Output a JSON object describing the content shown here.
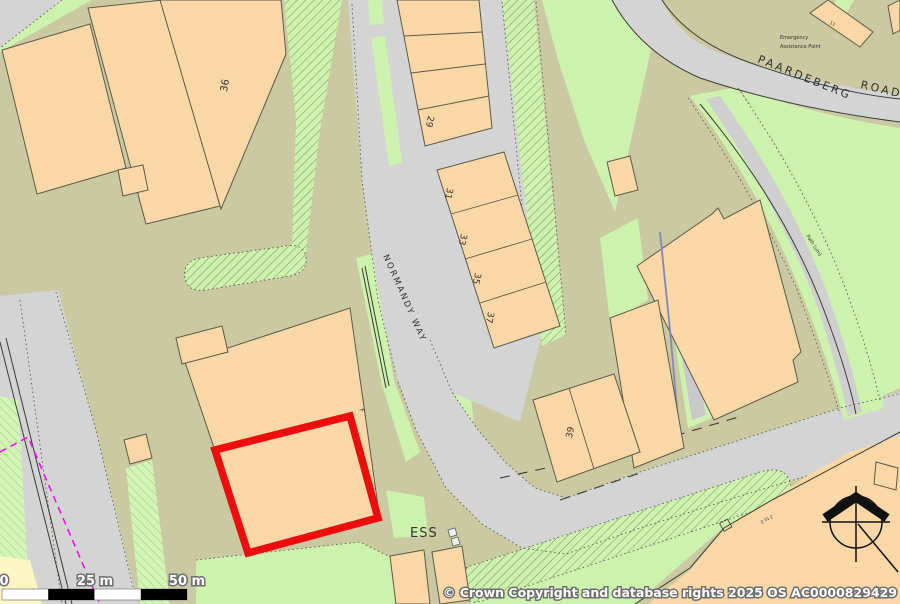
{
  "map": {
    "roads": {
      "normandy_way": "NORMANDY WAY",
      "paardeberg": "PAARDEBERG",
      "road_suffix": "ROAD"
    },
    "labels": {
      "ess": "ESS",
      "emergency_line1": "Emergency",
      "emergency_line2": "Assistance Point",
      "path": "Path (um)",
      "unit_range": "2 to 3",
      "floor_marker": "F"
    },
    "building_numbers": {
      "n36": "36",
      "n29": "29",
      "n31": "31",
      "n33": "33",
      "n35": "35",
      "n37": "37",
      "n39": "39",
      "n11": "11"
    },
    "scale_bar": {
      "t0": "0",
      "t25": "25 m",
      "t50": "50 m"
    },
    "copyright": "© Crown Copyright and database rights 2025 OS AC0000829429",
    "colors": {
      "land": "#cac9a2",
      "road": "#d4d4d4",
      "green": "#cdf2ae",
      "building": "#f9d7a6",
      "building_outline": "#5b5b4a",
      "selection_red": "#ee0d0d",
      "utility_magenta": "#ff00ff"
    }
  }
}
